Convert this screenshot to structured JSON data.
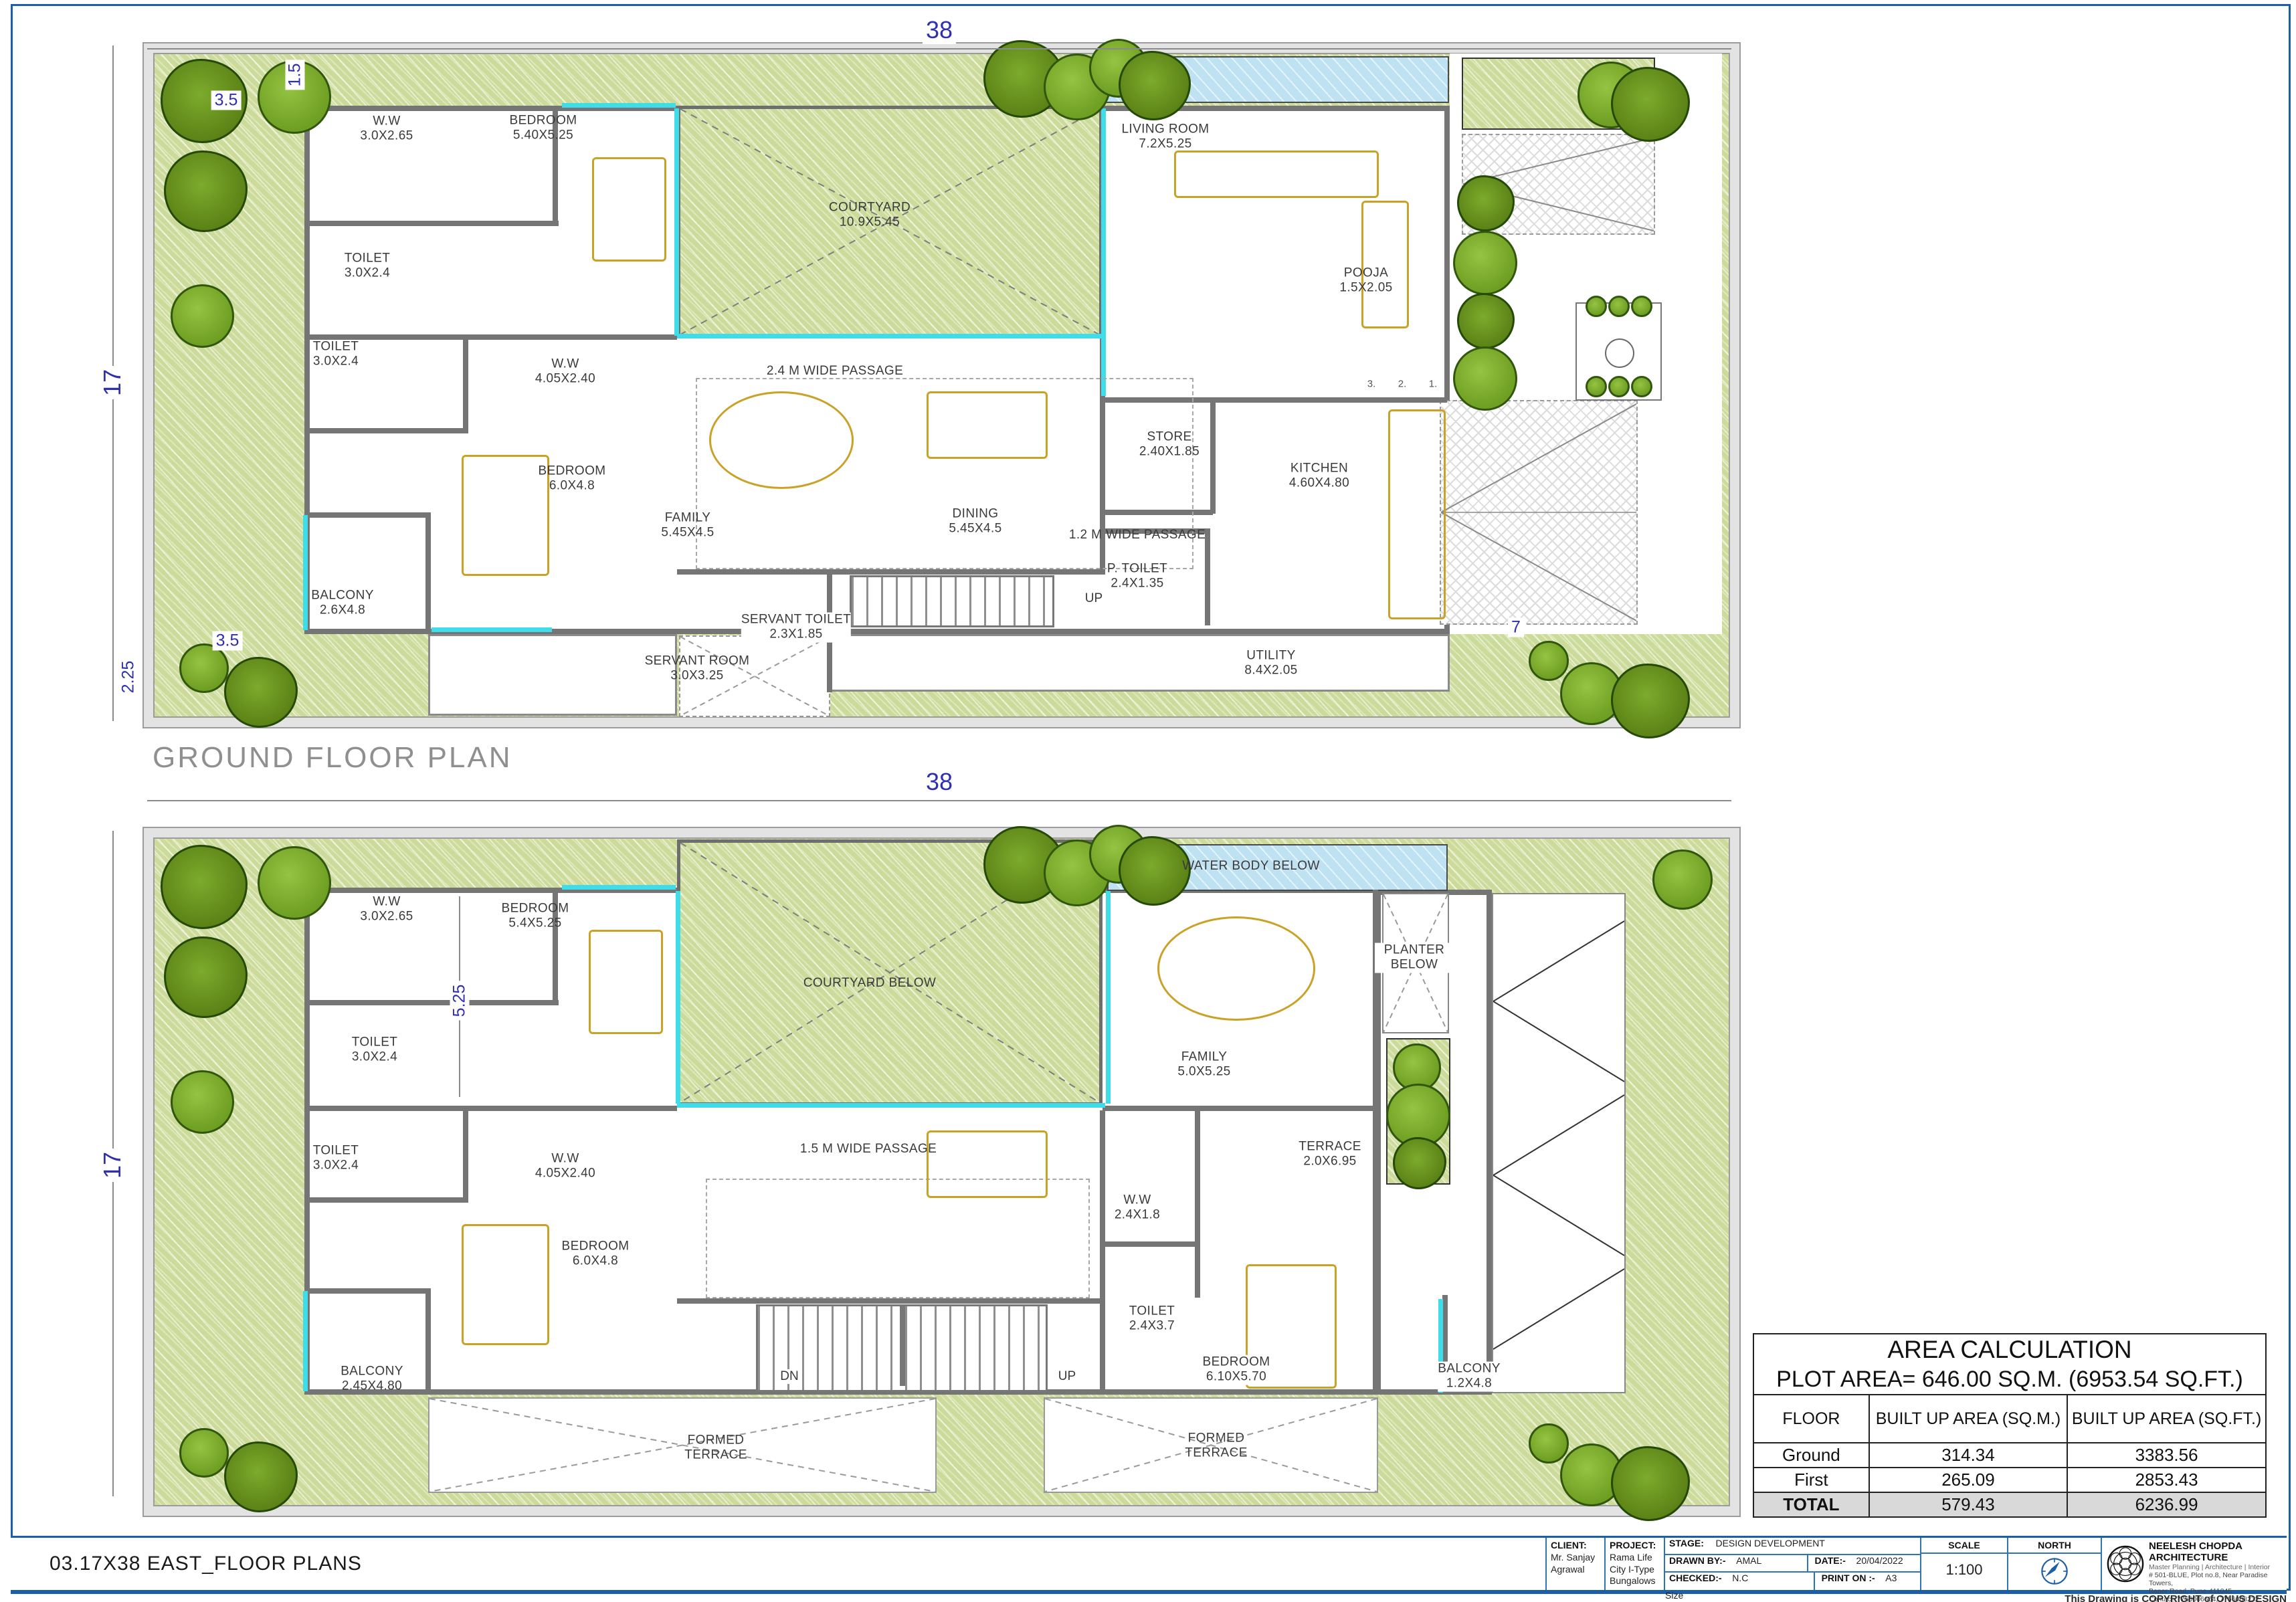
{
  "sheet": {
    "title": "03.17X38 EAST_FLOOR PLANS",
    "copyright": "This Drawing is COPYRIGHT of ONUS DESIGN"
  },
  "plans": {
    "ground": {
      "title": "GROUND FLOOR PLAN",
      "dim_top": "38",
      "dim_left": "17",
      "dim_side_strip": "1.5",
      "dim_garden_top": "3.5",
      "dim_garden_bottom": "3.5",
      "dim_bottom_left": "2.25",
      "dim_parking": "7",
      "grid_labels": [
        "3.",
        "2.",
        "1."
      ],
      "stair_up": "UP",
      "passage_1": "2.4 M WIDE PASSAGE",
      "passage_2": "1.2 M WIDE PASSAGE",
      "rooms": [
        {
          "name": "W.W",
          "size": "3.0X2.65"
        },
        {
          "name": "BEDROOM",
          "size": "5.40X5.25"
        },
        {
          "name": "COURTYARD",
          "size": "10.9X5.45"
        },
        {
          "name": "LIVING ROOM",
          "size": "7.2X5.25"
        },
        {
          "name": "POOJA",
          "size": "1.5X2.05"
        },
        {
          "name": "TOILET",
          "size": "3.0X2.4"
        },
        {
          "name": "TOILET",
          "size": "3.0X2.4"
        },
        {
          "name": "W.W",
          "size": "4.05X2.40"
        },
        {
          "name": "BEDROOM",
          "size": "6.0X4.8"
        },
        {
          "name": "FAMILY",
          "size": "5.45X4.5"
        },
        {
          "name": "DINING",
          "size": "5.45X4.5"
        },
        {
          "name": "STORE",
          "size": "2.40X1.85"
        },
        {
          "name": "KITCHEN",
          "size": "4.60X4.80"
        },
        {
          "name": "BALCONY",
          "size": "2.6X4.8"
        },
        {
          "name": "P. TOILET",
          "size": "2.4X1.35"
        },
        {
          "name": "SERVANT ROOM",
          "size": "3.0X3.25"
        },
        {
          "name": "SERVANT TOILET",
          "size": "2.3X1.85"
        },
        {
          "name": "UTILITY",
          "size": "8.4X2.05"
        }
      ]
    },
    "first": {
      "dim_top": "38",
      "dim_left": "17",
      "dim_bedroom": "5.25",
      "stair_dn": "DN",
      "stair_up": "UP",
      "passage_1": "1.5 M WIDE PASSAGE",
      "rooms": [
        {
          "name": "W.W",
          "size": "3.0X2.65"
        },
        {
          "name": "BEDROOM",
          "size": "5.4X5.25"
        },
        {
          "name": "COURTYARD BELOW",
          "size": ""
        },
        {
          "name": "WATER BODY BELOW",
          "size": ""
        },
        {
          "name": "PLANTER BELOW",
          "size": ""
        },
        {
          "name": "FAMILY",
          "size": "5.0X5.25"
        },
        {
          "name": "TERRACE",
          "size": "2.0X6.95"
        },
        {
          "name": "TOILET",
          "size": "3.0X2.4"
        },
        {
          "name": "TOILET",
          "size": "3.0X2.4"
        },
        {
          "name": "W.W",
          "size": "4.05X2.40"
        },
        {
          "name": "BEDROOM",
          "size": "6.0X4.8"
        },
        {
          "name": "W.W",
          "size": "2.4X1.8"
        },
        {
          "name": "TOILET",
          "size": "2.4X3.7"
        },
        {
          "name": "BEDROOM",
          "size": "6.10X5.70"
        },
        {
          "name": "BALCONY",
          "size": "2.45X4.80"
        },
        {
          "name": "BALCONY",
          "size": "1.2X4.8"
        },
        {
          "name": "FORMED TERRACE",
          "size": ""
        },
        {
          "name": "FORMED TERRACE",
          "size": ""
        }
      ]
    }
  },
  "area_table": {
    "title": "AREA CALCULATION",
    "plot_line": "PLOT AREA= 646.00 SQ.M. (6953.54 SQ.FT.)",
    "headers": [
      "FLOOR",
      "BUILT UP AREA (SQ.M.)",
      "BUILT UP AREA (SQ.FT.)"
    ],
    "rows": [
      {
        "floor": "Ground",
        "sqm": "314.34",
        "sqft": "3383.56"
      },
      {
        "floor": "First",
        "sqm": "265.09",
        "sqft": "2853.43"
      },
      {
        "floor": "TOTAL",
        "sqm": "579.43",
        "sqft": "6236.99"
      }
    ]
  },
  "title_block": {
    "client_label": "CLIENT:",
    "client": "Mr. Sanjay Agrawal",
    "project_label": "PROJECT:",
    "project": "Rama Life City I-Type Bungalows",
    "stage_label": "STAGE:",
    "stage": "DESIGN DEVELOPMENT",
    "drawn_label": "DRAWN BY:-",
    "drawn": "AMAL",
    "date_label": "DATE:-",
    "date": "20/04/2022",
    "checked_label": "CHECKED:-",
    "checked": "N.C",
    "print_label": "PRINT ON :-",
    "print": "A3 Size",
    "scale_label": "SCALE",
    "scale": "1:100",
    "north_label": "NORTH"
  },
  "firm": {
    "name": "NEELESH CHOPDA ARCHITECTURE",
    "tagline": "Master Planning | Architecture | Interior",
    "address1": "# 501-BLUE, Plot no.8, Near Paradise Towers,",
    "address2": "Baner Road, Pune-411045",
    "contact": "Contact: 7756006654, 7756008232"
  }
}
